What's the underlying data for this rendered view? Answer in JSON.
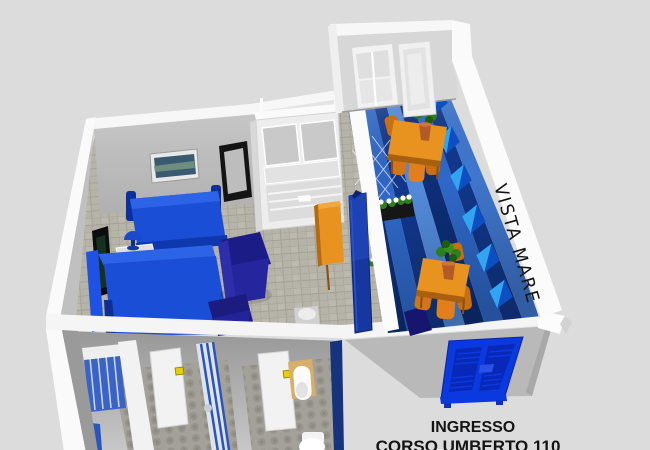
{
  "labels": {
    "vista_mare": "VISTA MARE",
    "ingresso": "INGRESSO",
    "address": "CORSO UMBERTO 110"
  },
  "colors": {
    "background": "#dcdcdc",
    "wall_white": "#f7f7f7",
    "wall_shade": "#c2c2c2",
    "room_floor": "#b6b3a9",
    "bath_floor": "#a3a199",
    "terrace_floor_dark": "#0d2e78",
    "terrace_stripe_mid": "#2f68c8",
    "terrace_stripe_light": "#528ada",
    "bed_blue": "#1a4ed6",
    "bed_blue_bright": "#2d63e6",
    "armchair_navy": "#1c1c86",
    "cushion_blue_light": "#31a5f2",
    "cushion_blue_dark": "#0b4fc0",
    "table_orange": "#e8931f",
    "door_blue": "#0a39e0",
    "door_blue_panel": "#0828b8",
    "handle_yellow": "#e6cf00",
    "plant_green": "#2e7d1e",
    "pot_terracotta": "#b35a28",
    "cabinet_tan": "#d9ae6a",
    "text_black": "#141414"
  }
}
